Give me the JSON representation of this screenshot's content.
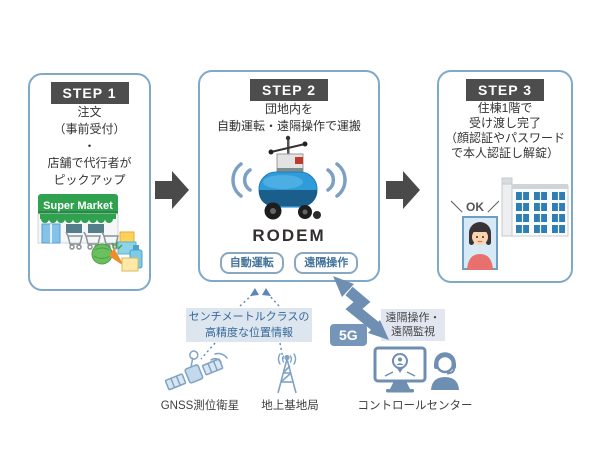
{
  "steps": [
    {
      "header": "STEP 1",
      "lines": [
        "注文",
        "（事前受付）",
        "・",
        "店舗で代行者が",
        "ピックアップ"
      ],
      "market_sign": "Super Market"
    },
    {
      "header": "STEP 2",
      "lines": [
        "団地内を",
        "自動運転・遠隔操作で運搬"
      ],
      "robot_name": "RODEM",
      "buttons": [
        "自動運転",
        "遠隔操作"
      ]
    },
    {
      "header": "STEP 3",
      "lines": [
        "住棟1階で",
        "受け渡し完了",
        "（顔認証やパスワード",
        "で本人認証し解錠）"
      ],
      "ok_label": "＼ OK ／"
    }
  ],
  "network": {
    "position_info_lines": [
      "センチメートルクラスの",
      "高精度な位置情報"
    ],
    "gnss_label": "GNSS測位衛星",
    "base_station_label": "地上基地局",
    "five_g_label": "5G",
    "remote_lines": [
      "遠隔操作・",
      "遠隔監視"
    ],
    "control_center_label": "コントロールセンター"
  },
  "icons": {
    "supermarket": "supermarket-illustration",
    "robot": "delivery-robot-rodem",
    "wireless": "wireless-signal-icon",
    "apartment": "apartment-building-icon",
    "face_photo": "resident-face-photo",
    "satellite": "gnss-satellite-icon",
    "base_station": "ground-base-station-icon",
    "zigzag": "5g-link-arrow",
    "monitor": "monitoring-display-icon",
    "operator": "operator-headset-icon"
  },
  "colors": {
    "step_border": "#7fa9c9",
    "header_bg": "#4d4d4d",
    "arrow_gray": "#4a4a4a",
    "accent_blue": "#6e8fb2",
    "five_g_bg": "#7596b8",
    "info_label_bg": "#dde6ee",
    "remote_label_bg": "#e1e6f0",
    "info_text": "#36689a",
    "market_green": "#2fa14f",
    "robot_blue": "#2f9bd8"
  }
}
